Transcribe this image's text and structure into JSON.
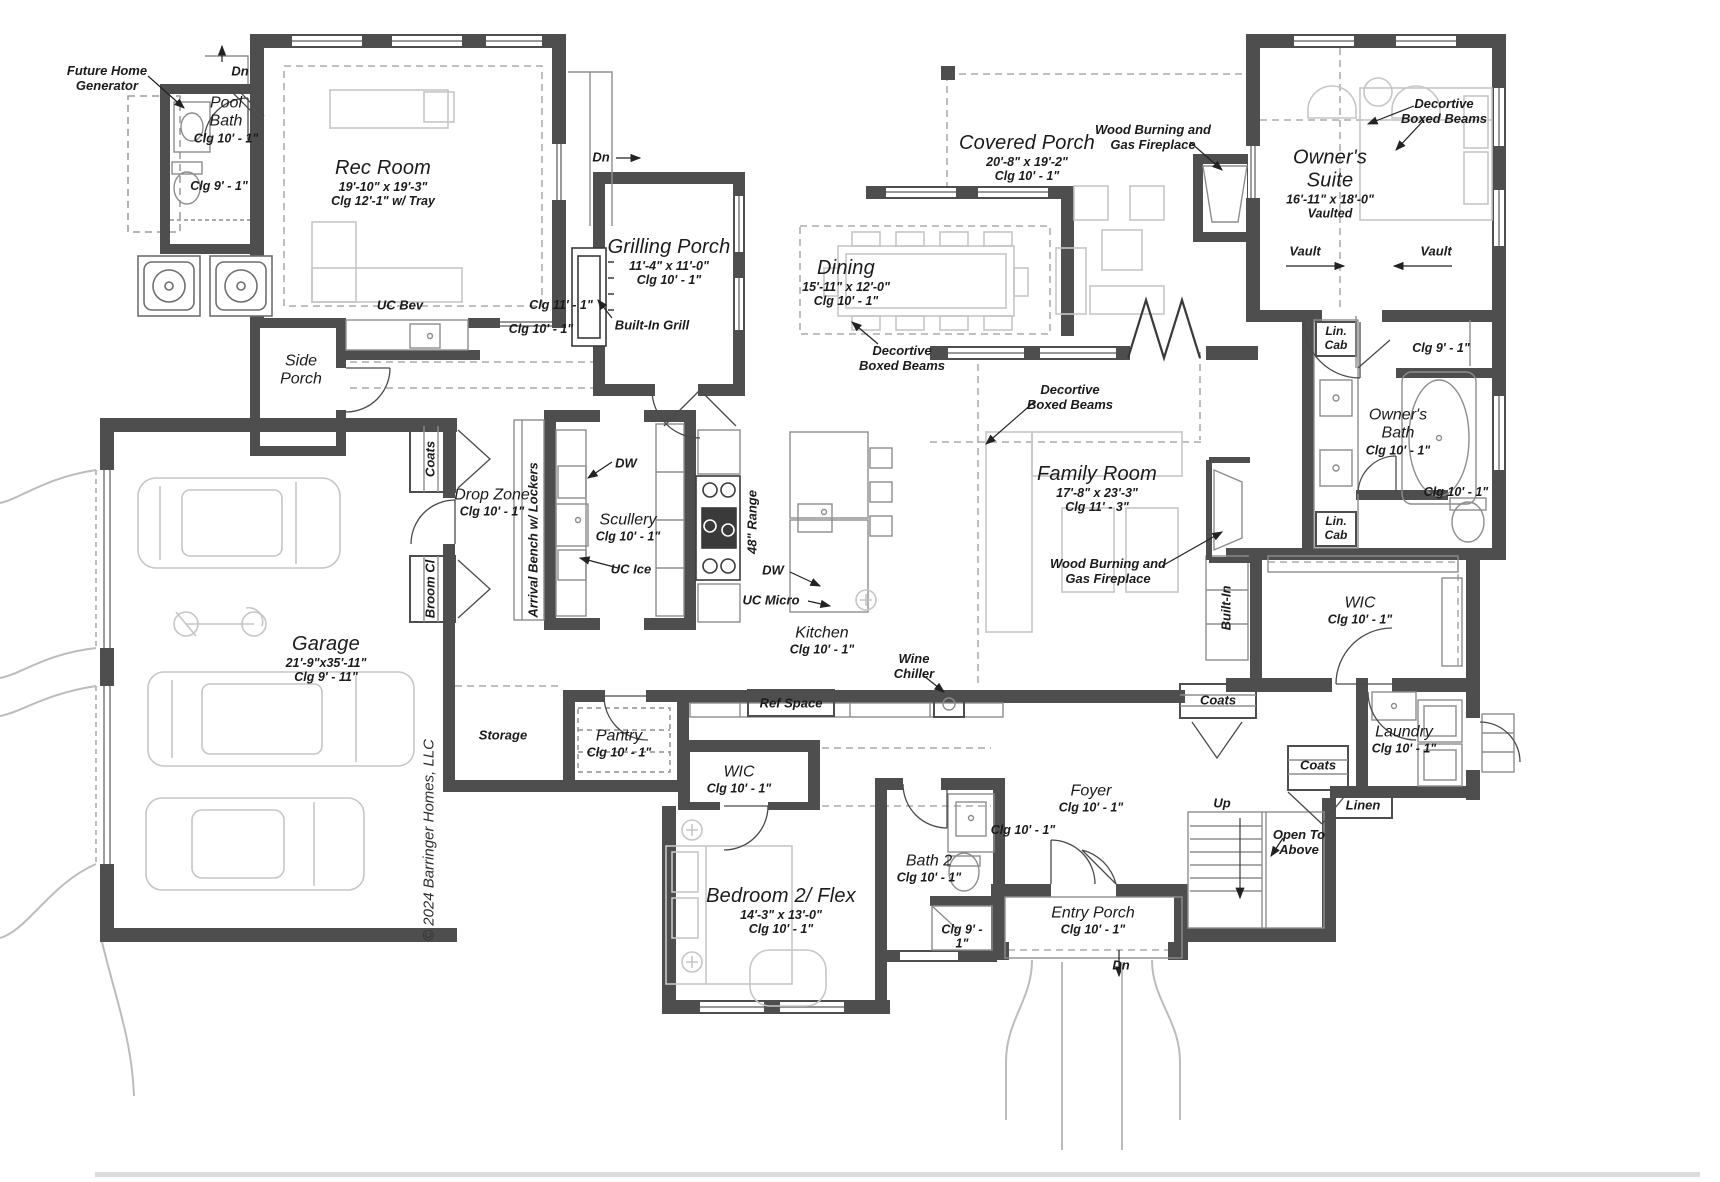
{
  "plan": {
    "title": "First floor plan",
    "copyright": "© 2024 Barringer Homes, LLC"
  },
  "rooms": {
    "rec": {
      "name": "Rec Room",
      "dims": "19'-10\" x 19'-3\"",
      "clg": "Clg 12'-1\" w/ Tray"
    },
    "pool": {
      "name": "Pool Bath",
      "clg": "Clg 10' - 1\"",
      "clg2": "Clg 9' - 1\""
    },
    "grill": {
      "name": "Grilling Porch",
      "dims": "11'-4\" x 11'-0\"",
      "clg": "Clg 10' - 1\""
    },
    "dining": {
      "name": "Dining",
      "dims": "15'-11\" x 12'-0\"",
      "clg": "Clg 10' - 1\""
    },
    "cporch": {
      "name": "Covered Porch",
      "dims": "20'-8\" x 19'-2\"",
      "clg": "Clg 10' - 1\""
    },
    "suite": {
      "name": "Owner's Suite",
      "dims": "16'-11\" x 18'-0\"",
      "extra": "Vaulted"
    },
    "obath": {
      "name": "Owner's Bath",
      "clg": "Clg 10' - 1\"",
      "shower_clg": "Clg 9' - 1\"",
      "wc_clg": "Clg 10' - 1\""
    },
    "owic": {
      "name": "WIC",
      "clg": "Clg 10' - 1\""
    },
    "family": {
      "name": "Family Room",
      "dims": "17'-8\" x 23'-3\"",
      "clg": "Clg 11' - 3\""
    },
    "kitchen": {
      "name": "Kitchen",
      "clg": "Clg 10' - 1\""
    },
    "scullery": {
      "name": "Scullery",
      "clg": "Clg 10' - 1\""
    },
    "dropzone": {
      "name": "Drop Zone",
      "clg": "Clg 10' - 1\""
    },
    "sideporch": {
      "name": "Side Porch"
    },
    "garage": {
      "name": "Garage",
      "dims": "21'-9\"x35'-11\"",
      "clg": "Clg 9' - 11\""
    },
    "storage": {
      "name": "Storage"
    },
    "pantry": {
      "name": "Pantry",
      "clg": "Clg 10' - 1\""
    },
    "wic2": {
      "name": "WIC",
      "clg": "Clg 10' - 1\""
    },
    "bed2": {
      "name": "Bedroom 2/ Flex",
      "dims": "14'-3\" x 13'-0\"",
      "clg": "Clg 10' - 1\""
    },
    "bath2": {
      "name": "Bath 2",
      "clg": "Clg 10' - 1\"",
      "shower_clg": "Clg 9' - 1\""
    },
    "foyer": {
      "name": "Foyer",
      "clg": "Clg 10' - 1\""
    },
    "entry": {
      "name": "Entry Porch",
      "clg": "Clg 10' - 1\""
    },
    "laundry": {
      "name": "Laundry",
      "clg": "Clg 10' - 1\""
    }
  },
  "labels": {
    "future_generator": "Future Home Generator",
    "dn": "Dn",
    "up": "Up",
    "open_above": "Open To Above",
    "uc_bev": "UC Bev",
    "clg_11_1": "Clg 11' - 1\"",
    "clg_10_1": "Clg 10' - 1\"",
    "built_in_grill": "Built-In Grill",
    "decortive": "Decortive Boxed Beams",
    "wood_burning": "Wood Burning and Gas Fireplace",
    "vault": "Vault",
    "lin_cab": "Lin. Cab",
    "built_in": "Built-In",
    "coats": "Coats",
    "broom": "Broom Cl",
    "range48": "48\" Range",
    "dw": "DW",
    "uc_micro": "UC Micro",
    "uc_ice": "UC Ice",
    "wine_chiller": "Wine Chiller",
    "ref_space": "Ref Space",
    "arrival_bench": "Arrival Bench w/ Lockers",
    "linen": "Linen"
  }
}
